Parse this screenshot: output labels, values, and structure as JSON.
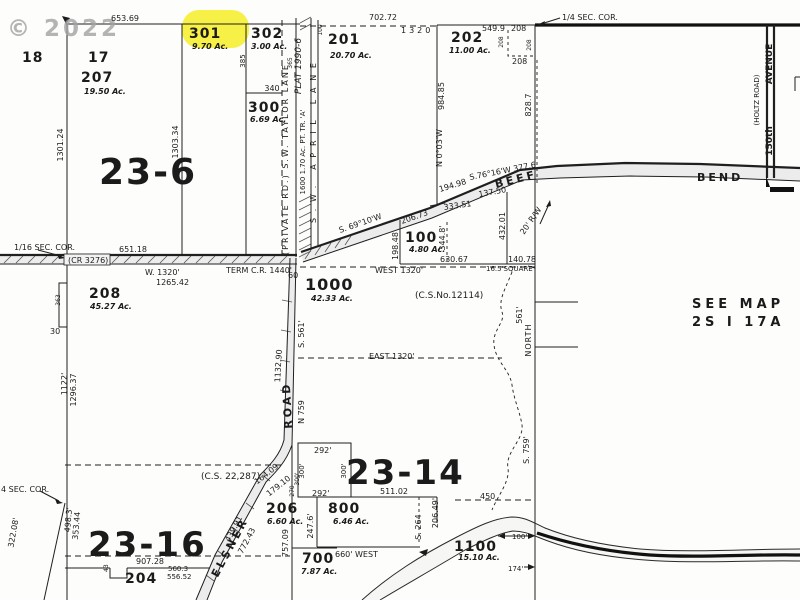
{
  "copyright": "© 2022",
  "sections": {
    "s236": "23-6",
    "s2314": "23-14",
    "s2316": "23-16"
  },
  "see_map": {
    "l1": "SEE MAP",
    "l2": "2S I 17A"
  },
  "corners": {
    "quarter_ne": "1/4 SEC. COR.",
    "sixteenth_w": "1/16 SEC. COR.",
    "quarter_sw": "4 SEC. COR."
  },
  "parcels": {
    "n18": "18",
    "n17": "17",
    "n207": "207",
    "a207": "19.50 Ac.",
    "n301": "301",
    "a301": "9.70 Ac.",
    "n302": "302",
    "a302": "3.00 Ac.",
    "n300": "300",
    "a300": "6.69 Ac.",
    "n201": "201",
    "a201": "20.70 Ac.",
    "n202": "202",
    "a202": "11.00 Ac.",
    "n100": "100",
    "a100": "4.80 Ac.",
    "n208": "208",
    "a208": "45.27 Ac.",
    "n1000": "1000",
    "a1000": "42.33 Ac.",
    "n1600": "1600 1.70 Ac. PT. TR. 'A'",
    "n204": "204",
    "n206": "206",
    "a206": "6.60 Ac.",
    "n700": "700",
    "a700": "7.87 Ac.",
    "n800": "800",
    "a800": "6.46 Ac.",
    "n1100": "1100",
    "a1100": "15.10 Ac."
  },
  "roads": {
    "taylor": "(PRIVATE RD.)  S.W.  TAYLOR  LANE",
    "april": "S.W.  APRIL  LANE",
    "plat": "PLAT 1990-6",
    "cr3276": "(CR 3276)",
    "term": "TERM C.R. 1440'",
    "beef": "BEEF",
    "bend": "BEND",
    "elsner": "ELSNER",
    "road": "ROAD",
    "holtz": "(HOLTZ ROAD)",
    "ave": "AVENUE",
    "ave_num": "150th",
    "rw": "20' R/W"
  },
  "surveys": {
    "cs12114": "(C.S.No.12114)",
    "cs22287": "(C.S. 22,287)"
  },
  "dims": {
    "d653": "653.69",
    "d702": "702.72",
    "d1320": "1320",
    "d5499": "549.9",
    "d208a": "208",
    "d208b": "208",
    "d208c": "208",
    "d208d": "208",
    "d98485": "984.85",
    "n003": "N 0°03'W",
    "d8287": "828.7",
    "d385": "385",
    "d365": "365",
    "d100": "100",
    "d340": "340",
    "d130124": "1301.24",
    "d130334": "1303.34",
    "d65118": "651.18",
    "w1320": "W. 1320'",
    "d126542": "1265.42",
    "d60": "60",
    "west1320": "WEST  1320'",
    "d63067": "630.67",
    "sq": "16.5'SQUARE",
    "d14078": "140.78",
    "b1": "S. 69°10'W",
    "d20673": "206.73",
    "d19498": "194.98",
    "b2": "S.76°16'W  377.6",
    "d19848": "198.48",
    "d33351": "333.51",
    "d3448": "344.8'",
    "d13750": "137.50",
    "d43201": "432.01",
    "east1320": "EAST  1320'",
    "d561": "561'",
    "north": "NORTH",
    "s561": "S. 561'",
    "d113290": "1132.90",
    "n759": "N 759",
    "s759": "S. 759'",
    "d363": "363",
    "d30": "30",
    "d1122": "1122'",
    "d129637": "1296.37",
    "d32208": "322.08'",
    "d4983": "498.3'",
    "d35344": "353.44",
    "d90728": "907.28",
    "d5603": "560.3",
    "d55652": "556.52",
    "d43": "43",
    "d16409": "164.09",
    "d17910": "179.10",
    "d270": "270",
    "d300a": "300'",
    "d300b": "300'",
    "d300c": "300'",
    "d75709": "757.09",
    "d43991": "439.91",
    "d77243": "772.43",
    "d292a": "292'",
    "d292b": "292'",
    "d51102": "511.02",
    "d2476": "247.6'",
    "d20649": "206.49'",
    "s264": "S. 264",
    "d660": "660' WEST",
    "d450": "450",
    "d100f": "100'",
    "d174": "174'"
  }
}
